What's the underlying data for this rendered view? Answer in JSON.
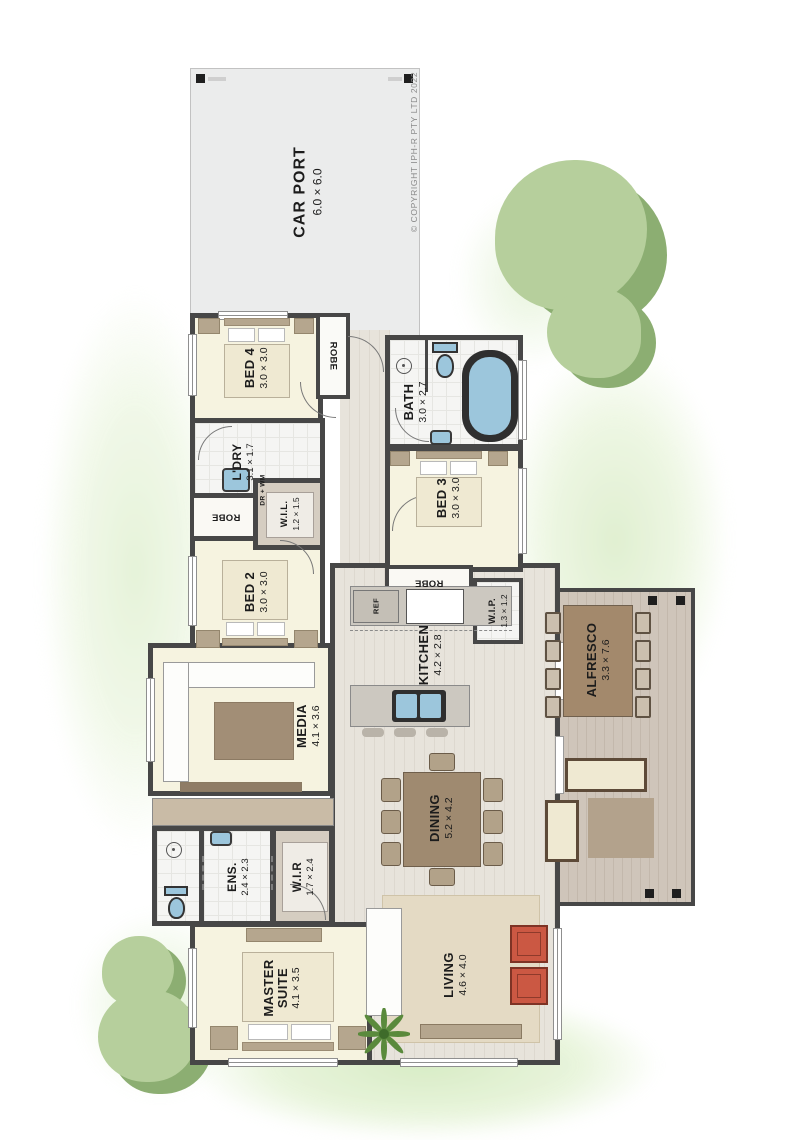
{
  "copyright": "©  COPYRIGHT IPH-R PTY LTD 2022",
  "rooms": {
    "carport": {
      "name": "CAR PORT",
      "dims": "6.0 × 6.0"
    },
    "bed4": {
      "name": "BED 4",
      "dims": "3.0 × 3.0"
    },
    "robe_bed4": {
      "name": "ROBE"
    },
    "bath": {
      "name": "BATH",
      "dims": "3.0 × 2.7"
    },
    "ldry": {
      "name": "L'DRY",
      "dims": "3.1 × 1.7"
    },
    "dr_wm": {
      "name": "DR + WM"
    },
    "wil": {
      "name": "W.I.L.",
      "dims": "1.2 × 1.5"
    },
    "robe_bed2": {
      "name": "ROBE"
    },
    "bed3": {
      "name": "BED 3",
      "dims": "3.0 × 3.0"
    },
    "robe_bed3": {
      "name": "ROBE"
    },
    "bed2": {
      "name": "BED 2",
      "dims": "3.0 × 3.0"
    },
    "media": {
      "name": "MEDIA",
      "dims": "4.1 × 3.6"
    },
    "kitchen": {
      "name": "KITCHEN",
      "dims": "4.2 × 2.8"
    },
    "ref": {
      "name": "REF"
    },
    "wip": {
      "name": "W.I.P.",
      "dims": "1.3 × 1.2"
    },
    "alfresco": {
      "name": "ALFRESCO",
      "dims": "3.3 × 7.6"
    },
    "dining": {
      "name": "DINING",
      "dims": "5.2 × 4.2"
    },
    "ens": {
      "name": "ENS.",
      "dims": "2.4 × 2.3"
    },
    "wir": {
      "name": "W.I.R",
      "dims": "1.7 × 2.4"
    },
    "master": {
      "name": "MASTER SUITE",
      "dims": "4.1 × 3.5"
    },
    "living": {
      "name": "LIVING",
      "dims": "4.6 × 4.0"
    }
  },
  "colors": {
    "wall": "#474747",
    "floor_cream": "#f6f3e0",
    "deck": "#cfc5ba",
    "water": "#9cc6dc",
    "armchair_red": "#cb5843",
    "tree_light": "#b6cf9c",
    "tree_dark": "#8cae72",
    "wash_green": "#dff0cf"
  }
}
